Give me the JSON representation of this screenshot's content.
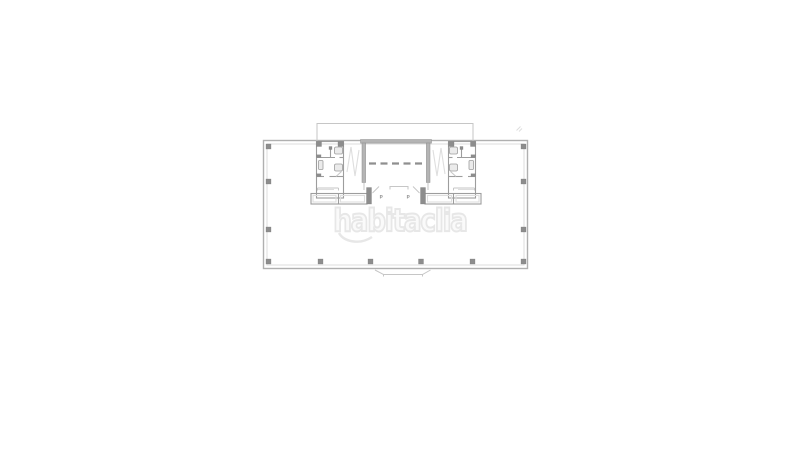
{
  "watermark": {
    "text": "habitaclia"
  },
  "plan": {
    "p_mark_left": "P",
    "p_mark_right": "P"
  },
  "colors": {
    "bg": "#ffffff",
    "wall": "#b0b0b0",
    "wall-light": "#dcdcdc",
    "wall-dark": "#8d8d8d",
    "partition": "#9d9d9d",
    "detail-light": "#c6c6c6",
    "stair": "#dedede",
    "fixture-fill": "#ebebeb",
    "dash": "#8f8f8f",
    "p-mark": "#9a9a9a",
    "watermark-stroke": "#e7e7e7",
    "watermark-fill": "#fafafa"
  }
}
